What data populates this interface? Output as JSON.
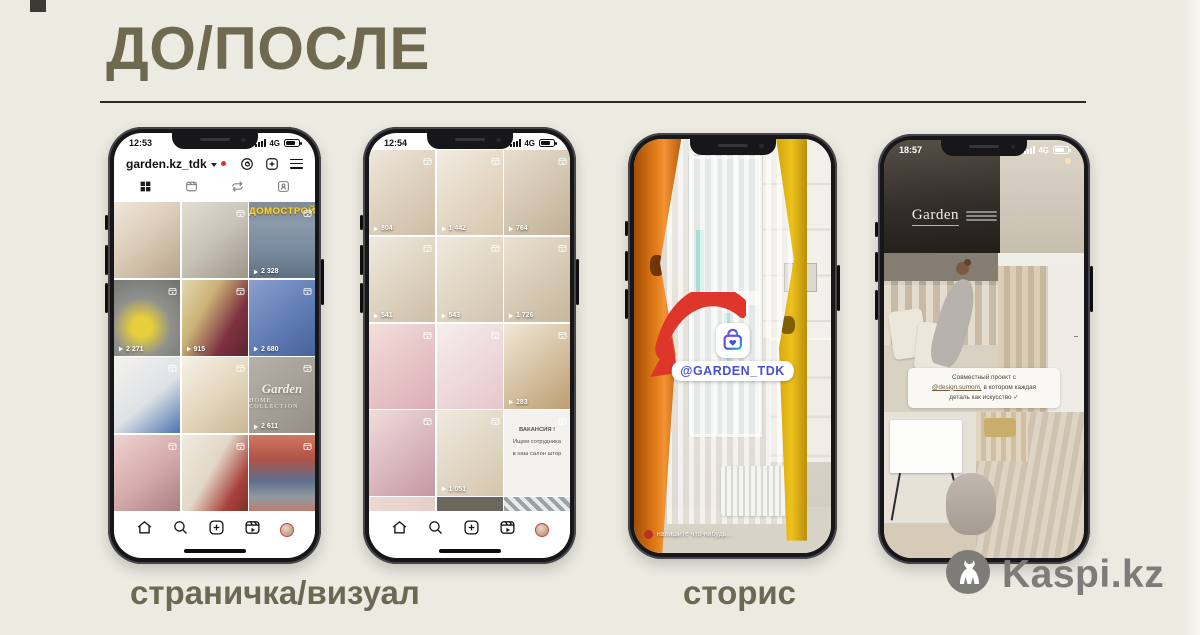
{
  "slide": {
    "title": "ДО/ПОСЛЕ",
    "caption_left": "страничка/визуал",
    "caption_right": "сторис",
    "watermark": "Kaspi.kz"
  },
  "profile_phone": {
    "time": "12:53",
    "network": "4G",
    "username": "garden.kz_tdk",
    "grid": [
      {
        "bg": "linear-gradient(140deg,#efe7da 0%,#dccdb9 45%,#b9a48c 100%)"
      },
      {
        "bg": "linear-gradient(140deg,#e3ddd4 0%,#c9c2b7 50%,#9d948a 100%)",
        "corner": true
      },
      {
        "bg": "linear-gradient(180deg,#7d8da0 0%,#8a9aab 30%,#76879a 70%,#5f7082 100%)",
        "corner": true,
        "sign": "ДОМОСТРОЙ",
        "views": "2 328"
      },
      {
        "bg": "radial-gradient(circle at 42% 62%,#e7cf3c 0%,#e7cf3c 16%,#90918d 48%,#6f716e 100%)",
        "corner": true,
        "views": "2 271"
      },
      {
        "bg": "linear-gradient(120deg,#e5d7b4 0%,#cbb276 35%,#7e3140 70%,#5d2430 100%)",
        "corner": true,
        "views": "915"
      },
      {
        "bg": "linear-gradient(140deg,#8ba0cc 0%,#6480b8 50%,#48629c 100%)",
        "corner": true,
        "views": "2 680"
      },
      {
        "bg": "linear-gradient(140deg,#f4f2ee 0%,#dfe2e6 55%,#4a74ad 100%)",
        "corner": true
      },
      {
        "bg": "linear-gradient(140deg,#f6f1e7 0%,#e3d5bb 55%,#c9b694 100%)",
        "corner": true
      },
      {
        "bg": "linear-gradient(140deg,#b6b1a9 0%,#948f87 100%)",
        "corner": true,
        "logo": [
          "Garden",
          "HOME COLLECTION"
        ],
        "views": "2 611"
      },
      {
        "bg": "linear-gradient(140deg,#eed3d1 0%,#d4a9a9 55%,#a97f85 100%)",
        "corner": true
      },
      {
        "bg": "linear-gradient(120deg,#f0eadf 0%,#e2d8c8 45%,#a8423a 78%,#7e2f2a 100%)",
        "corner": true
      },
      {
        "bg": "linear-gradient(180deg,#cd7862 0%,#b05346 32%,#5e6f8d 60%,#93999f 82%,#b97e72 100%)",
        "corner": true
      }
    ]
  },
  "grid_phone": {
    "time": "12:54",
    "network": "4G",
    "grid": [
      {
        "bg": "linear-gradient(140deg,#eee7da,#cdbda4)",
        "corner": true,
        "views": "804"
      },
      {
        "bg": "linear-gradient(140deg,#f2ece1,#d7c6ab)",
        "corner": true,
        "views": "1 442"
      },
      {
        "bg": "linear-gradient(140deg,#e8dfd0,#c1b096)",
        "corner": true,
        "views": "764"
      },
      {
        "bg": "linear-gradient(140deg,#f0eade,#cdbfa7)",
        "corner": true,
        "views": "541"
      },
      {
        "bg": "linear-gradient(140deg,#f0e9db,#d1c5b0)",
        "corner": true,
        "views": "543"
      },
      {
        "bg": "linear-gradient(140deg,#eae2d2,#c6b69c)",
        "corner": true,
        "views": "1 726"
      },
      {
        "bg": "linear-gradient(140deg,#f2dfdb,#dcadb5)",
        "corner": true
      },
      {
        "bg": "linear-gradient(140deg,#f6efec,#e6c6cc)",
        "corner": true
      },
      {
        "bg": "linear-gradient(140deg,#f0e8d8,#bd9e70)",
        "corner": true,
        "views": "283"
      },
      {
        "bg": "linear-gradient(140deg,#efdddb,#c697a4)",
        "corner": true
      },
      {
        "bg": "linear-gradient(140deg,#f0eadf,#d4c6ae)",
        "corner": true,
        "views": "1 051"
      },
      {
        "bg": "#f4f2ee",
        "corner": true,
        "lines": [
          "ВАКАНСИЯ !",
          "Ищем сотрудника",
          "в наш салон штор"
        ]
      },
      {
        "bg": "linear-gradient(90deg,#ecd9d4,#e6cfc8)",
        "partial": true
      },
      {
        "bg": "#6b675f",
        "partial": true
      },
      {
        "bg": "repeating-linear-gradient(45deg,#9aa0a8 0 4px,#e9e9e7 4px 8px)",
        "partial": true
      }
    ]
  },
  "story_phone": {
    "mention": "@GARDEN_TDK",
    "reply_placeholder": "напишите что-нибудь…"
  },
  "story_phone2": {
    "time": "18:57",
    "network": "4G",
    "brand": "Garden",
    "caption_l1": "Совместный проект с",
    "caption_mention": "@design.sumom,",
    "caption_l2": " в котором каждая",
    "caption_l3": "деталь как искусство ✓"
  }
}
